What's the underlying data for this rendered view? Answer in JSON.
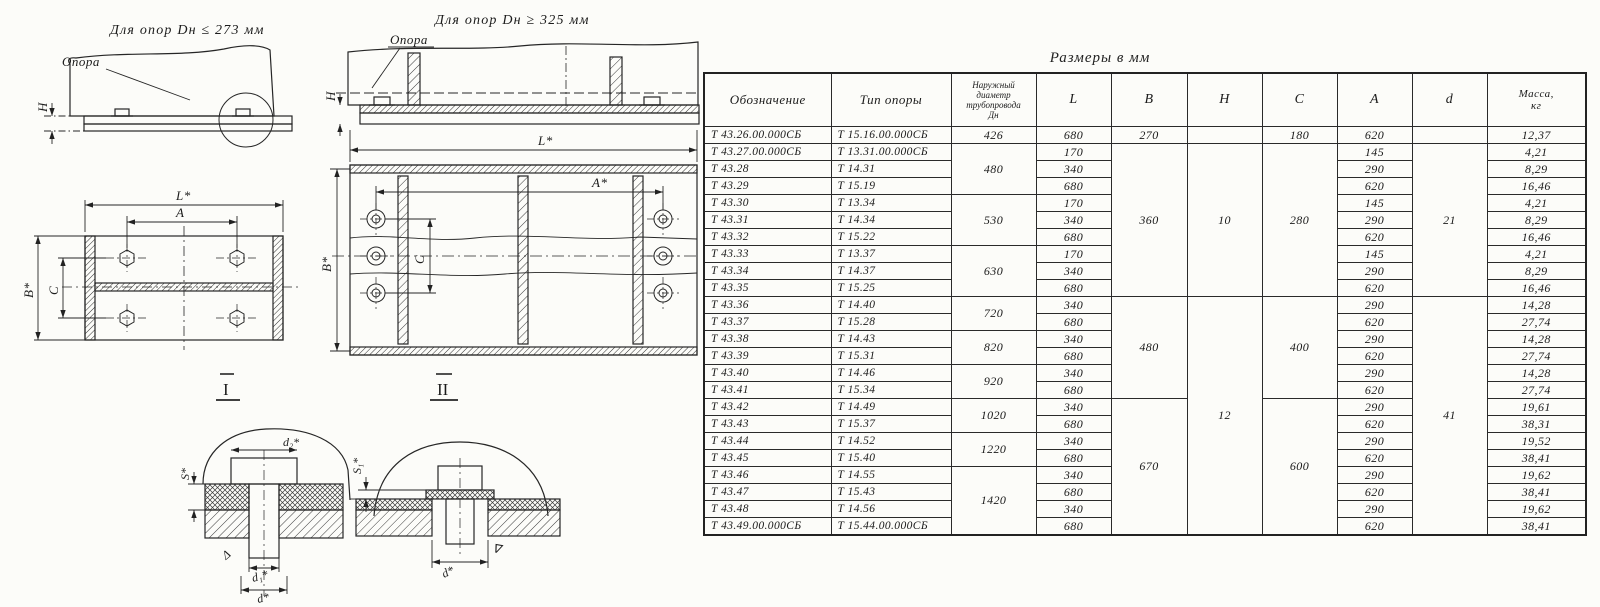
{
  "title": "Размеры в мм",
  "table": {
    "headers": [
      {
        "name": "designation",
        "lines": [
          "Обозначение"
        ]
      },
      {
        "name": "support-type",
        "lines": [
          "Тип  опоры"
        ]
      },
      {
        "name": "pipe-diameter",
        "lines": [
          "Наружный",
          "диаметр",
          "трубопровода",
          "Дн"
        ]
      },
      {
        "name": "l",
        "lines": [
          "L"
        ]
      },
      {
        "name": "b",
        "lines": [
          "B"
        ]
      },
      {
        "name": "h",
        "lines": [
          "H"
        ]
      },
      {
        "name": "c",
        "lines": [
          "C"
        ]
      },
      {
        "name": "a",
        "lines": [
          "A"
        ]
      },
      {
        "name": "d",
        "lines": [
          "d"
        ]
      },
      {
        "name": "mass",
        "lines": [
          "Масса,",
          "кг"
        ]
      }
    ],
    "rows": [
      {
        "des": "Т 43.26.00.000СБ",
        "type": "Т 15.16.00.000СБ",
        "dn": "426",
        "dnSpan": 1,
        "l": "680",
        "b": "270",
        "bSpan": 1,
        "h": "",
        "hSpan": 1,
        "c": "180",
        "cSpan": 1,
        "a": "620",
        "d": "",
        "dSpan": 1,
        "mass": "12,37"
      },
      {
        "des": "Т 43.27.00.000СБ",
        "type": "Т 13.31.00.000СБ",
        "dn": "480",
        "dnSpan": 3,
        "l": "170",
        "b": "360",
        "bSpan": 9,
        "h": "10",
        "hSpan": 9,
        "c": "280",
        "cSpan": 9,
        "a": "145",
        "d": "21",
        "dSpan": 9,
        "mass": "4,21"
      },
      {
        "des": "Т 43.28",
        "type": "Т 14.31",
        "l": "340",
        "a": "290",
        "mass": "8,29"
      },
      {
        "des": "Т 43.29",
        "type": "Т 15.19",
        "l": "680",
        "a": "620",
        "mass": "16,46"
      },
      {
        "des": "Т 43.30",
        "type": "Т 13.34",
        "dn": "530",
        "dnSpan": 3,
        "l": "170",
        "a": "145",
        "mass": "4,21"
      },
      {
        "des": "Т 43.31",
        "type": "Т 14.34",
        "l": "340",
        "a": "290",
        "mass": "8,29"
      },
      {
        "des": "Т 43.32",
        "type": "Т 15.22",
        "l": "680",
        "a": "620",
        "mass": "16,46"
      },
      {
        "des": "Т 43.33",
        "type": "Т 13.37",
        "dn": "630",
        "dnSpan": 3,
        "l": "170",
        "a": "145",
        "mass": "4,21"
      },
      {
        "des": "Т 43.34",
        "type": "Т 14.37",
        "l": "340",
        "a": "290",
        "mass": "8,29"
      },
      {
        "des": "Т 43.35",
        "type": "Т 15.25",
        "l": "680",
        "a": "620",
        "mass": "16,46"
      },
      {
        "des": "Т 43.36",
        "type": "Т 14.40",
        "dn": "720",
        "dnSpan": 2,
        "l": "340",
        "b": "480",
        "bSpan": 6,
        "h": "12",
        "hSpan": 14,
        "c": "400",
        "cSpan": 6,
        "a": "290",
        "d": "41",
        "dSpan": 14,
        "mass": "14,28"
      },
      {
        "des": "Т 43.37",
        "type": "Т 15.28",
        "l": "680",
        "a": "620",
        "mass": "27,74"
      },
      {
        "des": "Т 43.38",
        "type": "Т 14.43",
        "dn": "820",
        "dnSpan": 2,
        "l": "340",
        "a": "290",
        "mass": "14,28"
      },
      {
        "des": "Т 43.39",
        "type": "Т 15.31",
        "l": "680",
        "a": "620",
        "mass": "27,74"
      },
      {
        "des": "Т 43.40",
        "type": "Т 14.46",
        "dn": "920",
        "dnSpan": 2,
        "l": "340",
        "a": "290",
        "mass": "14,28"
      },
      {
        "des": "Т 43.41",
        "type": "Т 15.34",
        "l": "680",
        "a": "620",
        "mass": "27,74"
      },
      {
        "des": "Т 43.42",
        "type": "Т 14.49",
        "dn": "1020",
        "dnSpan": 2,
        "l": "340",
        "b": "670",
        "bSpan": 8,
        "c": "600",
        "cSpan": 8,
        "a": "290",
        "mass": "19,61"
      },
      {
        "des": "Т 43.43",
        "type": "Т 15.37",
        "l": "680",
        "a": "620",
        "mass": "38,31"
      },
      {
        "des": "Т 43.44",
        "type": "Т 14.52",
        "dn": "1220",
        "dnSpan": 2,
        "l": "340",
        "a": "290",
        "mass": "19,52"
      },
      {
        "des": "Т 43.45",
        "type": "Т 15.40",
        "l": "680",
        "a": "620",
        "mass": "38,41"
      },
      {
        "des": "Т 43.46",
        "type": "Т 14.55",
        "dn": "1420",
        "dnSpan": 4,
        "l": "340",
        "a": "290",
        "mass": "19,62"
      },
      {
        "des": "Т 43.47",
        "type": "Т 15.43",
        "l": "680",
        "a": "620",
        "mass": "38,41"
      },
      {
        "des": "Т 43.48",
        "type": "Т 14.56",
        "l": "340",
        "a": "290",
        "mass": "19,62"
      },
      {
        "des": "Т 43.49.00.000СБ",
        "type": "Т 15.44.00.000СБ",
        "l": "680",
        "a": "620",
        "mass": "38,41"
      }
    ]
  },
  "drawings": {
    "view1": {
      "title": "Для  опор  Dн ≤ 273 мм",
      "label_support": "Опора",
      "dim_h": "H"
    },
    "view2": {
      "title": "Для  опор  Dн ≥ 325 мм",
      "label_support": "Опора",
      "dim_h": "H"
    },
    "plan1": {
      "dim_l": "L*",
      "dim_a": "A",
      "dim_b": "B*",
      "dim_c": "C",
      "section_mark": "I"
    },
    "plan2": {
      "dim_l": "L*",
      "dim_a": "A*",
      "dim_b": "B*",
      "dim_c": "C",
      "section_mark": "II"
    },
    "detail1": {
      "dim_d2": "d₂*",
      "dim_s": "S*",
      "dim_d1": "d₁*",
      "dim_d": "d*",
      "finish_mark": "Δ"
    },
    "detail2": {
      "dim_s1": "S₁*",
      "dim_d": "d*",
      "finish_mark": "∇"
    }
  }
}
